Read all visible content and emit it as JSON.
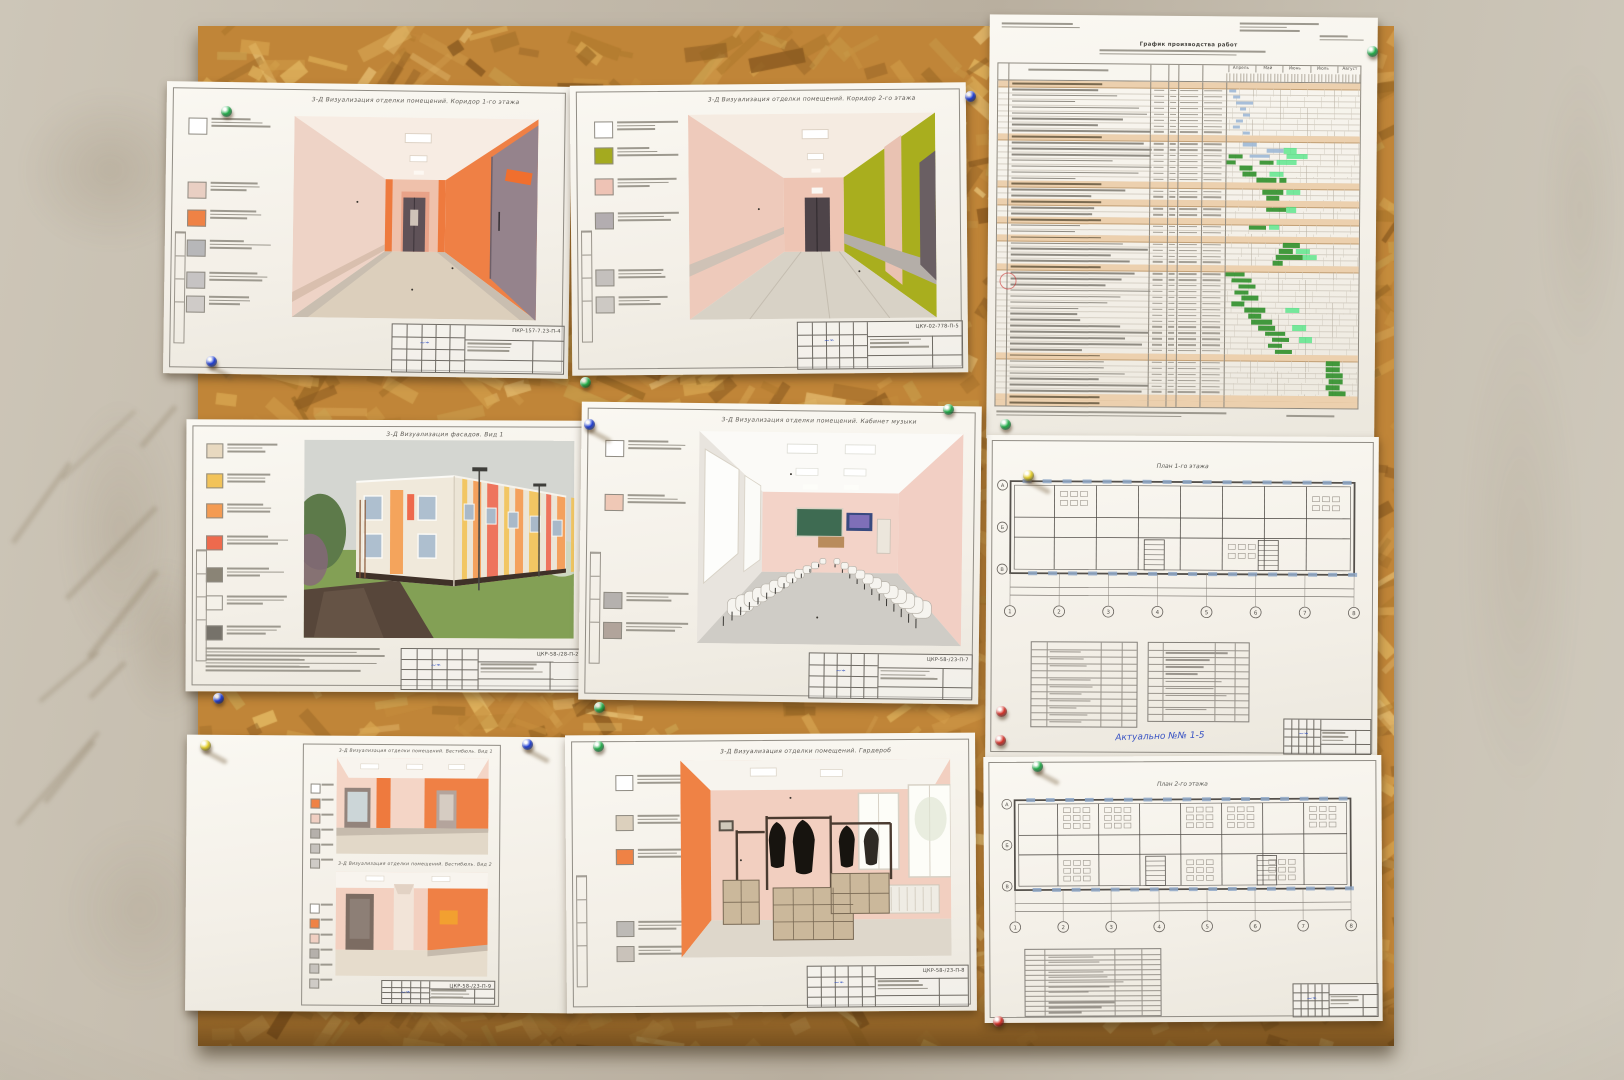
{
  "photo": {
    "description": "Архитектурные листы (3-Д визуализации, график работ, поэтажные планы), приколотые кнопками к плите ОСБ на оштукатуренной стене"
  },
  "palette": {
    "wall": "#c2b9aa",
    "board": "#c08538",
    "orange": "#ef8045",
    "peach": "#eed3c6",
    "olive": "#a9ae1e",
    "doorgray": "#95838c",
    "floor": "#dccfbc",
    "stripe": "#b4aea8",
    "fcream": "#f0e9db",
    "fyellow": "#f2c359",
    "forange": "#f49b52",
    "fred": "#ee6a4d",
    "plinth": "#3f3128",
    "grass": "#83a055",
    "sky": "#d4d6d1",
    "gblue": "#9db8d6",
    "ggreen": "#2f8f2a",
    "gbright": "#45e47e",
    "gsection": "#ecd0ae",
    "pin_green": "#22b14c",
    "pin_blue": "#1f3fd8",
    "pin_yellow": "#e8d22a",
    "pin_red": "#d8332a"
  },
  "pins": [
    {
      "c": "green",
      "x": 221,
      "y": 106,
      "sh": 0
    },
    {
      "c": "blue",
      "x": 206,
      "y": 356,
      "sh": 1
    },
    {
      "c": "green",
      "x": 580,
      "y": 377,
      "sh": 0
    },
    {
      "c": "blue",
      "x": 584,
      "y": 419,
      "sh": 1
    },
    {
      "c": "blue",
      "x": 965,
      "y": 91,
      "sh": 0
    },
    {
      "c": "green",
      "x": 1367,
      "y": 46,
      "sh": 0
    },
    {
      "c": "green",
      "x": 1000,
      "y": 419,
      "sh": 0
    },
    {
      "c": "yellow",
      "x": 1023,
      "y": 470,
      "sh": 1
    },
    {
      "c": "red",
      "x": 996,
      "y": 706,
      "sh": 0
    },
    {
      "c": "yellow",
      "x": 200,
      "y": 740,
      "sh": 1
    },
    {
      "c": "blue",
      "x": 522,
      "y": 739,
      "sh": 1
    },
    {
      "c": "green",
      "x": 593,
      "y": 741,
      "sh": 0
    },
    {
      "c": "red",
      "x": 995,
      "y": 735,
      "sh": 0
    },
    {
      "c": "green",
      "x": 1032,
      "y": 761,
      "sh": 1
    },
    {
      "c": "red",
      "x": 993,
      "y": 1016,
      "sh": 0
    },
    {
      "c": "green",
      "x": 594,
      "y": 702,
      "sh": 0
    },
    {
      "c": "green",
      "x": 943,
      "y": 404,
      "sh": 0
    },
    {
      "c": "blue",
      "x": 213,
      "y": 693,
      "sh": 0
    }
  ],
  "sheets": {
    "corridor1": {
      "title": "3-Д Визуализация отделки помещений. Коридор 1-го этажа",
      "code": "ПКР-157-7.23-П-4",
      "legend": [
        "#ffffff",
        "#e9cfc3",
        "#ef8245",
        "#b7b7b9",
        "#c6c3c3",
        "#cfcbc8"
      ]
    },
    "corridor2": {
      "title": "3-Д Визуализация отделки помещений. Коридор 2-го этажа",
      "code": "ЦКУ-02-778-П-5",
      "legend": [
        "#ffffff",
        "#a4aa1f",
        "#eec3b5",
        "#b3adb0",
        "#c4c0bd",
        "#cdc9c4"
      ]
    },
    "schedule": {
      "title": "График производства работ",
      "months": [
        "Апрель",
        "Май",
        "Июнь",
        "Июль",
        "Август"
      ],
      "cols": 40,
      "rows": [
        {
          "s": 1
        },
        {
          "b": [
            [
              1,
              3,
              "bl"
            ]
          ]
        },
        {
          "b": [
            [
              2,
              4,
              "bl"
            ]
          ]
        },
        {
          "b": [
            [
              3,
              8,
              "bl"
            ]
          ]
        },
        {
          "b": [
            [
              4,
              6,
              "bl"
            ]
          ]
        },
        {
          "b": [
            [
              5,
              7,
              "bl"
            ]
          ]
        },
        {
          "b": [
            [
              3,
              5,
              "bl"
            ]
          ]
        },
        {
          "b": [
            [
              2,
              4,
              "bl"
            ]
          ]
        },
        {
          "b": [
            [
              5,
              7,
              "bl"
            ]
          ]
        },
        {
          "s": 1
        },
        {
          "b": [
            [
              5,
              9,
              "bl"
            ]
          ]
        },
        {
          "b": [
            [
              12,
              17,
              "bl"
            ],
            [
              17,
              21,
              "br"
            ]
          ]
        },
        {
          "b": [
            [
              1,
              5,
              "gr"
            ],
            [
              7,
              13,
              "bl"
            ],
            [
              18,
              24,
              "br"
            ]
          ]
        },
        {
          "b": [
            [
              0,
              3,
              "gr"
            ],
            [
              10,
              14,
              "gr"
            ],
            [
              15,
              21,
              "br"
            ]
          ]
        },
        {
          "b": [
            [
              4,
              8,
              "gr"
            ]
          ]
        },
        {
          "b": [
            [
              5,
              9,
              "gr"
            ],
            [
              13,
              17,
              "br"
            ]
          ]
        },
        {
          "b": [
            [
              9,
              15,
              "gr"
            ],
            [
              16,
              18,
              "gr"
            ]
          ]
        },
        {
          "s": 1
        },
        {
          "b": [
            [
              11,
              17,
              "gr"
            ],
            [
              18,
              22,
              "br"
            ]
          ]
        },
        {
          "b": [
            [
              12,
              16,
              "gr"
            ]
          ]
        },
        {
          "s": 1
        },
        {
          "b": [
            [
              12,
              18,
              "gr"
            ],
            [
              18,
              21,
              "br"
            ]
          ]
        },
        {
          "b": []
        },
        {
          "s": 1
        },
        {
          "b": [
            [
              7,
              12,
              "gr"
            ],
            [
              13,
              16,
              "br"
            ]
          ]
        },
        {
          "b": []
        },
        {
          "s": 1
        },
        {
          "b": [
            [
              17,
              22,
              "gr"
            ]
          ]
        },
        {
          "b": [
            [
              16,
              20,
              "gr"
            ],
            [
              21,
              25,
              "br"
            ]
          ]
        },
        {
          "b": [
            [
              15,
              23,
              "gr"
            ],
            [
              23,
              27,
              "br"
            ]
          ]
        },
        {
          "b": [
            [
              14,
              17,
              "gr"
            ]
          ]
        },
        {
          "s": 1
        },
        {
          "b": [
            [
              0,
              6,
              "gr"
            ]
          ]
        },
        {
          "b": [
            [
              2,
              8,
              "gr"
            ]
          ]
        },
        {
          "b": [
            [
              4,
              9,
              "gr"
            ]
          ]
        },
        {
          "b": [
            [
              3,
              7,
              "gr"
            ]
          ]
        },
        {
          "b": [
            [
              5,
              10,
              "gr"
            ]
          ]
        },
        {
          "b": [
            [
              2,
              6,
              "gr"
            ]
          ]
        },
        {
          "b": [
            [
              6,
              12,
              "gr"
            ],
            [
              18,
              22,
              "br"
            ]
          ]
        },
        {
          "b": [
            [
              7,
              11,
              "gr"
            ]
          ]
        },
        {
          "b": [
            [
              8,
              14,
              "gr"
            ]
          ]
        },
        {
          "b": [
            [
              10,
              15,
              "gr"
            ],
            [
              20,
              24,
              "br"
            ]
          ]
        },
        {
          "b": [
            [
              12,
              18,
              "gr"
            ]
          ]
        },
        {
          "b": [
            [
              14,
              19,
              "gr"
            ],
            [
              22,
              26,
              "br"
            ]
          ]
        },
        {
          "b": [
            [
              13,
              17,
              "gr"
            ]
          ]
        },
        {
          "b": [
            [
              15,
              20,
              "gr"
            ]
          ]
        },
        {
          "s": 1
        },
        {
          "b": [
            [
              30,
              34,
              "gr"
            ]
          ]
        },
        {
          "b": [
            [
              30,
              34,
              "gr"
            ]
          ]
        },
        {
          "b": [
            [
              30,
              35,
              "gr"
            ]
          ]
        },
        {
          "b": [
            [
              31,
              35,
              "gr"
            ]
          ]
        },
        {
          "b": [
            [
              30,
              34,
              "gr"
            ]
          ]
        },
        {
          "b": [
            [
              31,
              36,
              "gr"
            ]
          ]
        },
        {
          "sum": 1
        },
        {
          "sum": 1
        }
      ]
    },
    "facade": {
      "title": "3-Д Визуализация фасадов. Вид 1",
      "code": "ЦКР-58-/28-П-2",
      "legend": [
        "#e8d9c0",
        "#f2c359",
        "#f49b52",
        "#ee6a4d",
        "#8a8476",
        "#f4f1e9",
        "#76726a"
      ]
    },
    "musicroom": {
      "title": "3-Д Визуализация отделки помещений. Кабинет музыки",
      "code": "ЦКР-58-/23-П-7",
      "legend": [
        "#ffffff",
        "#efc8b6",
        "#b5b1ae",
        "#b1a49b"
      ]
    },
    "plan1": {
      "title": "План 1-го этажа",
      "axis_numbers": [
        "1",
        "2",
        "3",
        "4",
        "5",
        "6",
        "7",
        "8"
      ],
      "axis_letters": [
        "А",
        "Б",
        "В"
      ],
      "note": "Актуально №№ 1-5"
    },
    "vestibule": {
      "title1": "3-Д Визуализация отделки помещений. Вестибюль. Вид 1",
      "title2": "3-Д Визуализация отделки помещений. Вестибюль. Вид 2",
      "code": "ЦКР-58-/23-П-9",
      "legend": [
        "#ffffff",
        "#ef8245",
        "#f0cfc2",
        "#b5b0ab",
        "#c6c2bd",
        "#cfcbc6"
      ]
    },
    "cloakroom": {
      "title": "3-Д Визуализация отделки помещений. Гардероб",
      "code": "ЦКР-58-/23-П-8",
      "legend": [
        "#ffffff",
        "#dcd0bd",
        "#ef8245",
        "#bdbab6",
        "#c9c2ba"
      ]
    },
    "plan2": {
      "title": "План 2-го этажа",
      "axis_numbers": [
        "1",
        "2",
        "3",
        "4",
        "5",
        "6",
        "7",
        "8"
      ],
      "axis_letters": [
        "А",
        "Б",
        "В"
      ]
    }
  }
}
